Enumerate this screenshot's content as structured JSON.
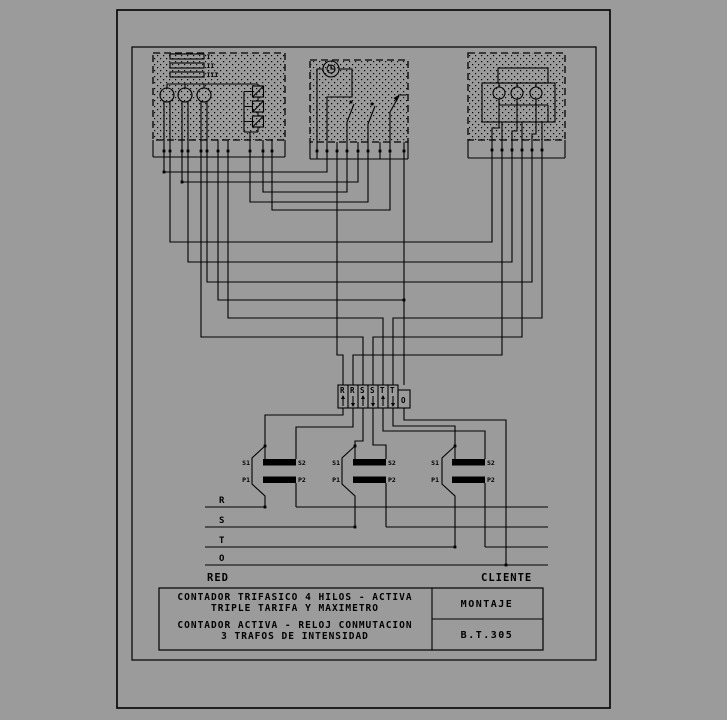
{
  "colors": {
    "background": "#9b9b9b",
    "line": "#000000"
  },
  "meter_box": {
    "registers": [
      "I",
      "II",
      "III"
    ]
  },
  "clock_box": {
    "icon": "clock-icon"
  },
  "maximeter_box": {},
  "terminal_block": {
    "cells": [
      {
        "label": "R",
        "arrow": "up"
      },
      {
        "label": "R",
        "arrow": "down"
      },
      {
        "label": "S",
        "arrow": "up"
      },
      {
        "label": "S",
        "arrow": "down"
      },
      {
        "label": "T",
        "arrow": "up"
      },
      {
        "label": "T",
        "arrow": "down"
      },
      {
        "label": "O",
        "arrow": "none"
      }
    ]
  },
  "cts": [
    {
      "s1": "S1",
      "s2": "S2",
      "p1": "P1",
      "p2": "P2"
    },
    {
      "s1": "S1",
      "s2": "S2",
      "p1": "P1",
      "p2": "P2"
    },
    {
      "s1": "S1",
      "s2": "S2",
      "p1": "P1",
      "p2": "P2"
    }
  ],
  "bus": {
    "phases": [
      "R",
      "S",
      "T",
      "O"
    ],
    "left_label": "RED",
    "right_label": "CLIENTE"
  },
  "title_block": {
    "line1": "CONTADOR TRIFASICO 4 HILOS - ACTIVA",
    "line2": "TRIPLE TARIFA Y MAXIMETRO",
    "line3": "CONTADOR ACTIVA - RELOJ CONMUTACION",
    "line4": "3 TRAFOS DE INTENSIDAD",
    "montaje": "MONTAJE",
    "ref": "B.T.305"
  }
}
